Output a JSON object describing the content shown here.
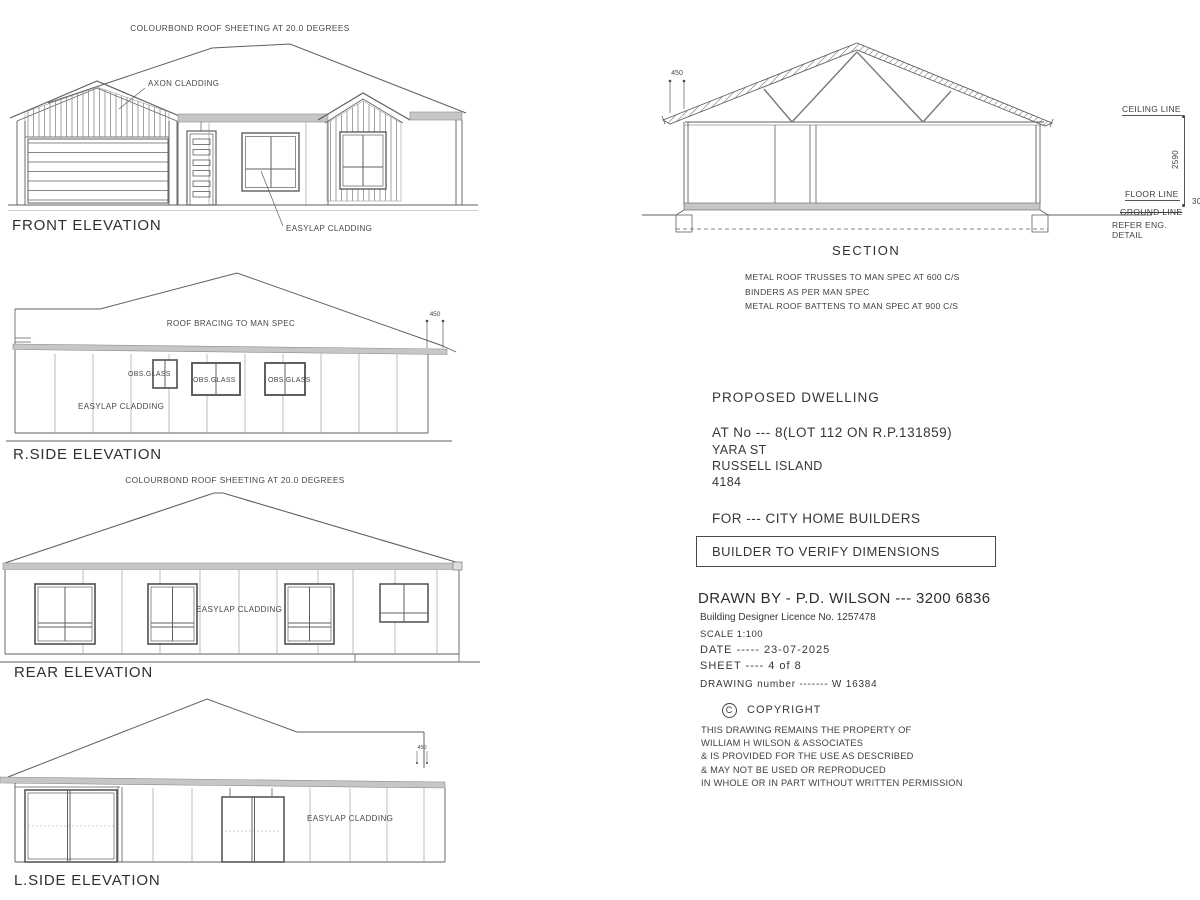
{
  "colors": {
    "line": "#5f5f5f",
    "fascia": "#c6c6c6",
    "text": "#3f3f3f"
  },
  "front": {
    "title": "FRONT ELEVATION",
    "roof_note": "COLOURBOND ROOF SHEETING AT 20.0 DEGREES",
    "axon_label": "AXON CLADDING",
    "easylap_label": "EASYLAP CLADDING"
  },
  "rside": {
    "title": "R.SIDE ELEVATION",
    "roof_note": "ROOF BRACING TO MAN SPEC",
    "easylap_label": "EASYLAP CLADDING",
    "obs_glass": "OBS.GLASS",
    "eave_dim": "450"
  },
  "rear": {
    "title": "REAR ELEVATION",
    "roof_note": "COLOURBOND ROOF SHEETING AT 20.0 DEGREES",
    "easylap_label": "EASYLAP CLADDING"
  },
  "lside": {
    "title": "L.SIDE ELEVATION",
    "easylap_label": "EASYLAP CLADDING",
    "eave_dim": "450"
  },
  "section": {
    "title": "SECTION",
    "eave_dim": "450",
    "ceiling_label": "CEILING LINE",
    "floor_label": "FLOOR LINE",
    "ground_label": "GROUND LINE",
    "refer_label": "REFER ENG. DETAIL",
    "wall_height": "2590",
    "slab_dim": "30",
    "notes": [
      "METAL ROOF TRUSSES TO MAN SPEC AT 600 C/S",
      "BINDERS AS PER MAN SPEC",
      "METAL ROOF BATTENS TO MAN SPEC AT 900 C/S"
    ]
  },
  "title_block": {
    "project": "PROPOSED  DWELLING",
    "address_line1": "AT No --- 8(LOT 112 ON R.P.131859)",
    "address_line2": "YARA ST",
    "address_line3": "RUSSELL ISLAND",
    "address_line4": "4184",
    "client": "FOR --- CITY HOME BUILDERS",
    "verify": "BUILDER TO VERIFY DIMENSIONS",
    "drawn_by": "DRAWN BY  - P.D. WILSON --- 3200 6836",
    "licence": "Building Designer Licence No. 1257478",
    "scale": "SCALE 1:100",
    "date": "DATE -----  23-07-2025",
    "sheet": "SHEET ----   4 of 8",
    "drawing_number": "DRAWING number  -------  W 16384",
    "copyright_symbol": "C",
    "copyright_title": "COPYRIGHT",
    "copyright_lines": [
      "THIS DRAWING REMAINS THE PROPERTY OF",
      "WILLIAM H WILSON & ASSOCIATES",
      "& IS PROVIDED FOR THE USE AS DESCRIBED",
      "& MAY NOT BE USED OR REPRODUCED",
      "IN WHOLE OR IN PART WITHOUT WRITTEN PERMISSION"
    ]
  }
}
